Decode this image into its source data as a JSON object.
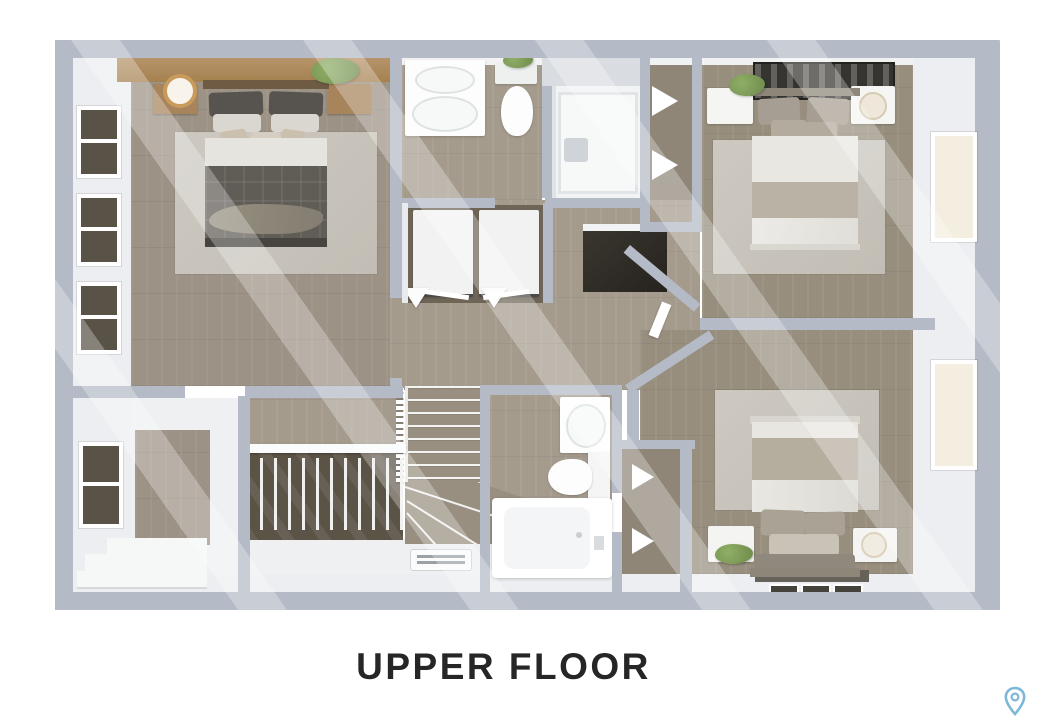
{
  "footer": {
    "title": "UPPER FLOOR",
    "pin_icon": "map-pin",
    "pin_color": "#7db7d9"
  },
  "plan": {
    "label": "upper-floor-3d-plan",
    "colors": {
      "wall": "#b4bac6",
      "wall_face": "#eceef1",
      "wood_floor": "#9e9486",
      "stairwell_dark": "#5b5345",
      "light_floor": "#eef0f2",
      "rug": "#c8c4bc",
      "bed_dark_duvet": "#605c56",
      "bed_light_duvet": "#e9e7e2",
      "shelf_wood": "#ad8a61",
      "plant_green": "#7c9757",
      "window_glass_dark": "#585247",
      "window_glass_light": "#f4eee0"
    },
    "rooms": [
      "master-bedroom",
      "bathroom",
      "shower-room",
      "linen-closet",
      "bedroom-2",
      "hallway",
      "laundry-closet",
      "staircase",
      "bathroom-2",
      "bedroom-3",
      "landing-room"
    ],
    "furniture_icons": [
      "bed",
      "nightstand",
      "lamp",
      "plant",
      "rug",
      "wall-art",
      "vanity-sink",
      "toilet",
      "shower",
      "washer",
      "dryer",
      "bathtub",
      "closet-shelves",
      "floor-vent",
      "steps",
      "railing"
    ]
  }
}
